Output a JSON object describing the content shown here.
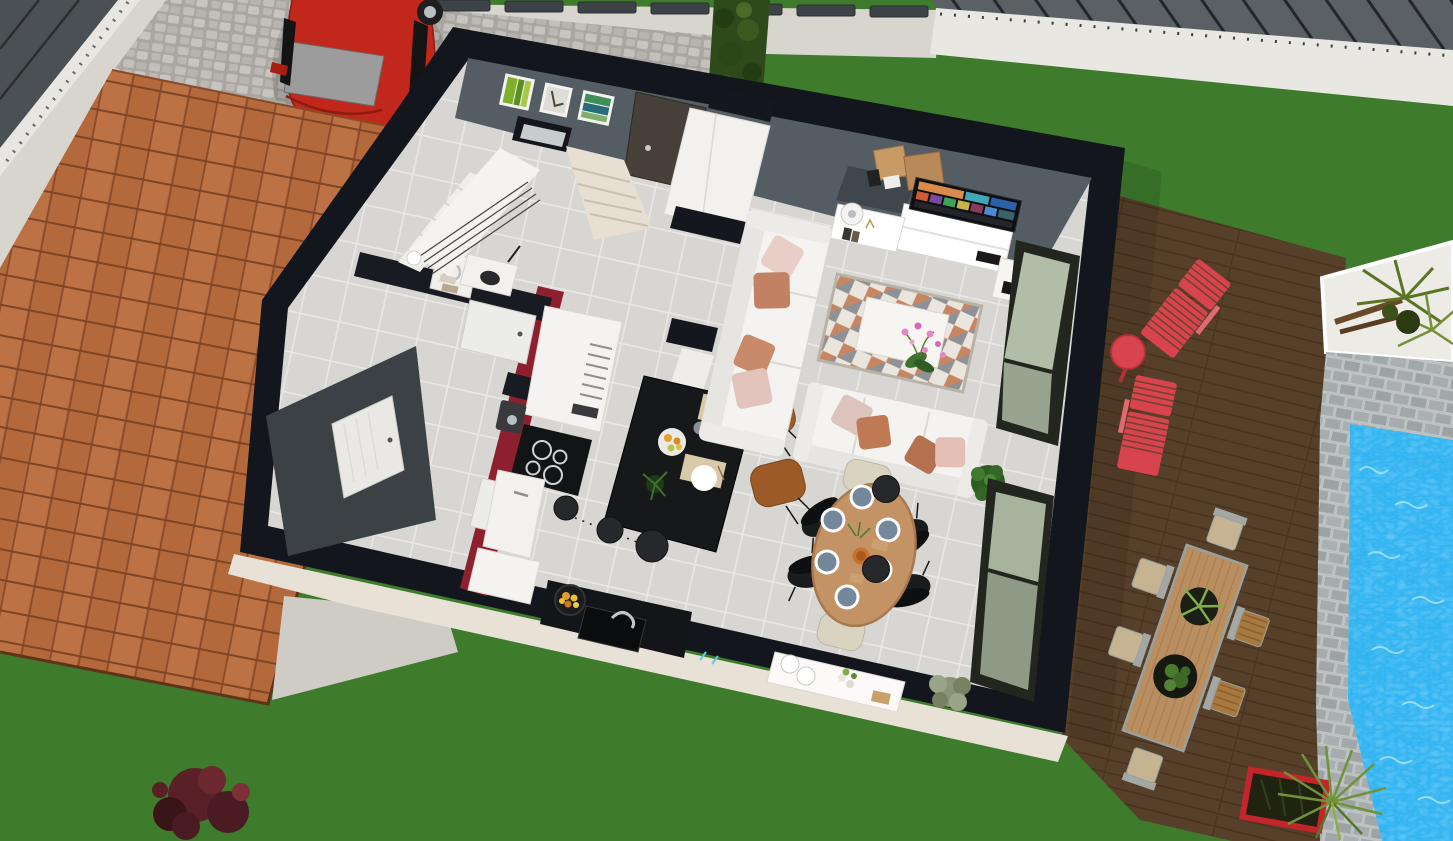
{
  "scene_type": "3d-home-design-aerial-view",
  "viewport": {
    "width_px": 1453,
    "height_px": 841
  },
  "palette": {
    "lawn": "#3E7D2B",
    "sidewalk": "#D8D5CF",
    "cobble": "#B2AFAA",
    "neighbor_roof": "#4B5054",
    "street": "#5A6064",
    "curb": "#E9E7E2",
    "hedge": "#2F4A1A",
    "fence_cap": "#3C4246",
    "car_red": "#C2271B",
    "car_glass": "#9C9C9C",
    "terracotta": "#B4693C",
    "garage_apron": "#CFCCC6",
    "cream_base": "#E7E1D6",
    "deck": "#57402A",
    "lounger_red": "#D8444E",
    "outdoor_table": "#B98E60",
    "outdoor_seat": "#C5B392",
    "gravel": "#EDEBE6",
    "paver": "#AFB5B6",
    "pool": "#2FB3F2",
    "ripple": "#A8E4FB",
    "planter_red": "#C4242C",
    "house_wall": "#14161E",
    "floor_tile": "#D7D6D2",
    "slate_wall": "#545D64",
    "accent_wall": "#3C4146",
    "red_wall": "#8E1F2F",
    "white_wall": "#F2F1EE",
    "wood_step": "#E7DFD2",
    "front_door": "#474039",
    "island_black": "#17181A",
    "bar_stool": "#9C5A28",
    "pendant": "#26282B",
    "sofa": "#F4F3F1",
    "pillow_pink": "#E9CEC8",
    "pillow_salmon": "#C28163",
    "pillow_rust": "#B4714F",
    "rug_light": "#EAE5DD",
    "rug_dark": "#8E9196",
    "rug_terra": "#C0754E",
    "tv_screen": "#0E0F11",
    "dining_wood": "#C39265",
    "plate_blue": "#74879B",
    "chair_black": "#1A1B1D",
    "chair_cream": "#D9D4C2",
    "window_glass": "#98A48F",
    "window_frame": "#23261F",
    "plant_green": "#3E7030",
    "plant_olive": "#8A9478",
    "orchid_pink": "#E585C2",
    "food_orange": "#E09B28",
    "shrub_maroon": "#5A2028",
    "palm_green": "#5C7324"
  },
  "exterior": {
    "driveway_surface": "cobblestone",
    "car": {
      "color": "#C2271B",
      "glass_color": "#9C9C9C",
      "wheels_visible": 2
    },
    "garage_roof": {
      "material": "terracotta-tiles",
      "color": "#B4693C"
    },
    "fence_caps_count": 7,
    "hedge_count": 1,
    "deck": {
      "material": "wood-planks",
      "color": "#57402A"
    },
    "sun_loungers": {
      "count": 2,
      "color": "#D8444E"
    },
    "deck_side_table": {
      "shape": "round",
      "color": "#D8444E"
    },
    "outdoor_dining": {
      "table_color": "#B98E60",
      "chair_count": 6,
      "planter_count": 2
    },
    "pool": {
      "water_color": "#2FB3F2",
      "surround": "gray-pavers"
    },
    "gravel_bed_plants": "palms",
    "red_planter_count": 1,
    "shrub_count": 1
  },
  "interior": {
    "walls": {
      "exterior_color": "#14161E",
      "feature_color": "#545D64",
      "accent_red": "#8E1F2F"
    },
    "floor_tile_color": "#D7D6D2",
    "entry": {
      "front_door_color": "#474039",
      "wall_art_count": 3,
      "staircase": "white-rail-wood-steps",
      "stair_window_count": 1,
      "wardrobe_count": 1
    },
    "kitchen": {
      "island_color": "#17181A",
      "bar_stools": {
        "count": 2,
        "color": "#9C5A28"
      },
      "pendant_lights": 3,
      "cooktop_burners": 4,
      "sink_count": 1,
      "pan_with_food": 1
    },
    "living": {
      "sofa_count": 2,
      "pillow_count": 8,
      "tv_count": 1,
      "rug_count": 1,
      "coffee_table_count": 1,
      "orchid_count": 1,
      "side_table_count": 1,
      "moving_boxes": 2,
      "potted_plants": 1
    },
    "dining": {
      "table_shape": "oval",
      "place_settings": 6,
      "black_chairs": 4,
      "cream_chairs": 2,
      "pendant_lights": 2,
      "sideboard_count": 1,
      "plants": 2
    },
    "utility": {
      "open_doors": 3,
      "accent_wall_color": "#3C4146",
      "appliance_count": 1
    },
    "windows": {
      "sliding_glass_count": 2,
      "glass_color": "#98A48F"
    }
  }
}
